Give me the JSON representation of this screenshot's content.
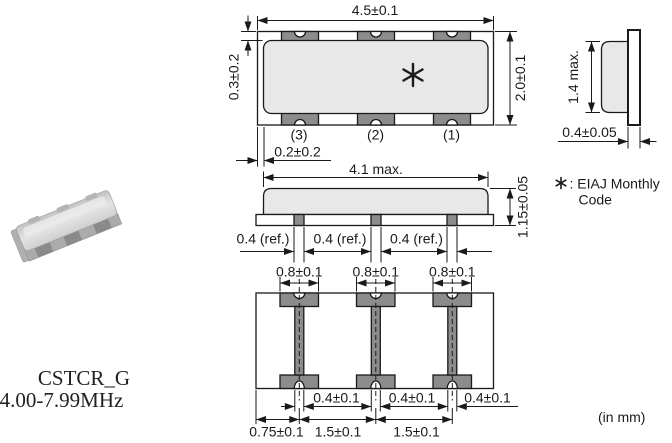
{
  "product": {
    "series": "CSTCR_G",
    "frequency_range": "4.00-7.99MHz"
  },
  "units_note": "(in mm)",
  "eiaj_note": {
    "marker_icon": "asterisk",
    "line1": ": EIAJ Monthly",
    "line2": "Code"
  },
  "top_view": {
    "width_dim": "4.5±0.1",
    "height_dim": "2.0±0.1",
    "electrode_edge_dim": "0.3±0.2",
    "body_margin_dim": "0.2±0.2",
    "marker_icon": "asterisk",
    "pins": [
      "(3)",
      "(2)",
      "(1)"
    ]
  },
  "front_view": {
    "width_dim": "4.1 max.",
    "height_dim": "1.15±0.05",
    "terminal_refs": [
      "0.4 (ref.)",
      "0.4 (ref.)",
      "0.4 (ref.)"
    ]
  },
  "side_view": {
    "height_dim": "1.4 max.",
    "substrate_dim": "0.4±0.05"
  },
  "bottom_view": {
    "pad_width_dims": [
      "0.8±0.1",
      "0.8±0.1",
      "0.8±0.1"
    ],
    "strip_width_dims": [
      "0.4±0.1",
      "0.4±0.1",
      "0.4±0.1"
    ],
    "pitch_dims": [
      "0.75±0.1",
      "1.5±0.1",
      "1.5±0.1"
    ]
  },
  "colors": {
    "body_fill": "#e8e8e8",
    "electrode_fill": "#8c8c8c",
    "line": "#1a1a1a",
    "background": "#ffffff"
  }
}
